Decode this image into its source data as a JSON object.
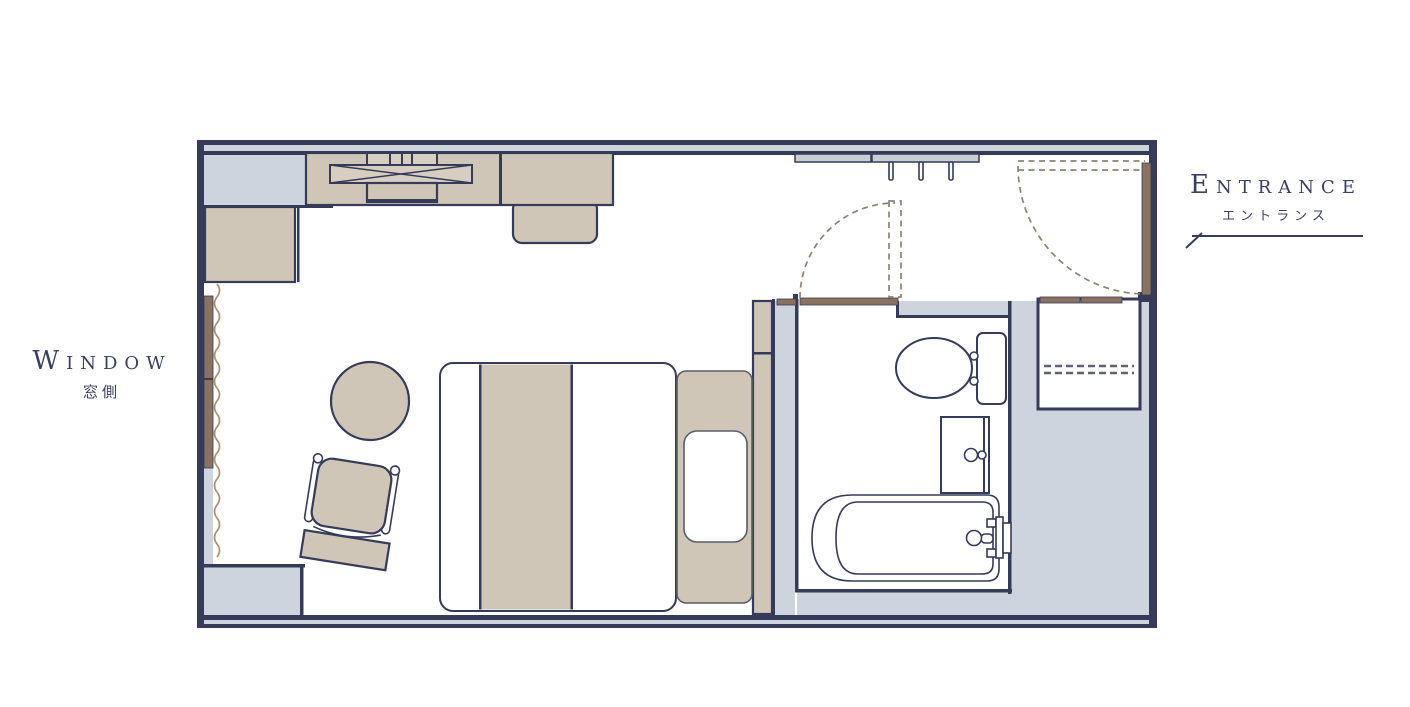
{
  "page": {
    "background": "#ffffff"
  },
  "labels": {
    "window": {
      "title": "Window",
      "subtitle": "窓側"
    },
    "entrance": {
      "title": "Entrance",
      "subtitle": "エントランス"
    }
  },
  "colors": {
    "outline": "#353b58",
    "wall_fill": "#cdd4dd",
    "furniture_fill": "#cfc6b7",
    "rack_fill": "#d6cec1",
    "wood": "#8a7261",
    "door_swing_dash": "#8b8473",
    "shelf_dash": "#5f6472",
    "curtain": "#a8926f",
    "hanger_fill": "#c9cdd4",
    "label_text": "#3a4160"
  },
  "plan": {
    "type": "hotel-room-floor-plan",
    "rooms": [
      "bedroom",
      "bathroom",
      "entrance-hall",
      "closet"
    ],
    "fixtures": [
      "counter-desk",
      "luggage-rack",
      "desk-chair",
      "wall-cabinet",
      "coat-hanger-rail",
      "double-bed",
      "bed-runner",
      "headboard",
      "pillow",
      "bedside-ledge",
      "round-table",
      "lounge-chair",
      "toilet",
      "washbasin",
      "bathtub",
      "entrance-door",
      "bathroom-door",
      "window",
      "curtain",
      "closet-shelf",
      "overhead-shelf"
    ]
  }
}
